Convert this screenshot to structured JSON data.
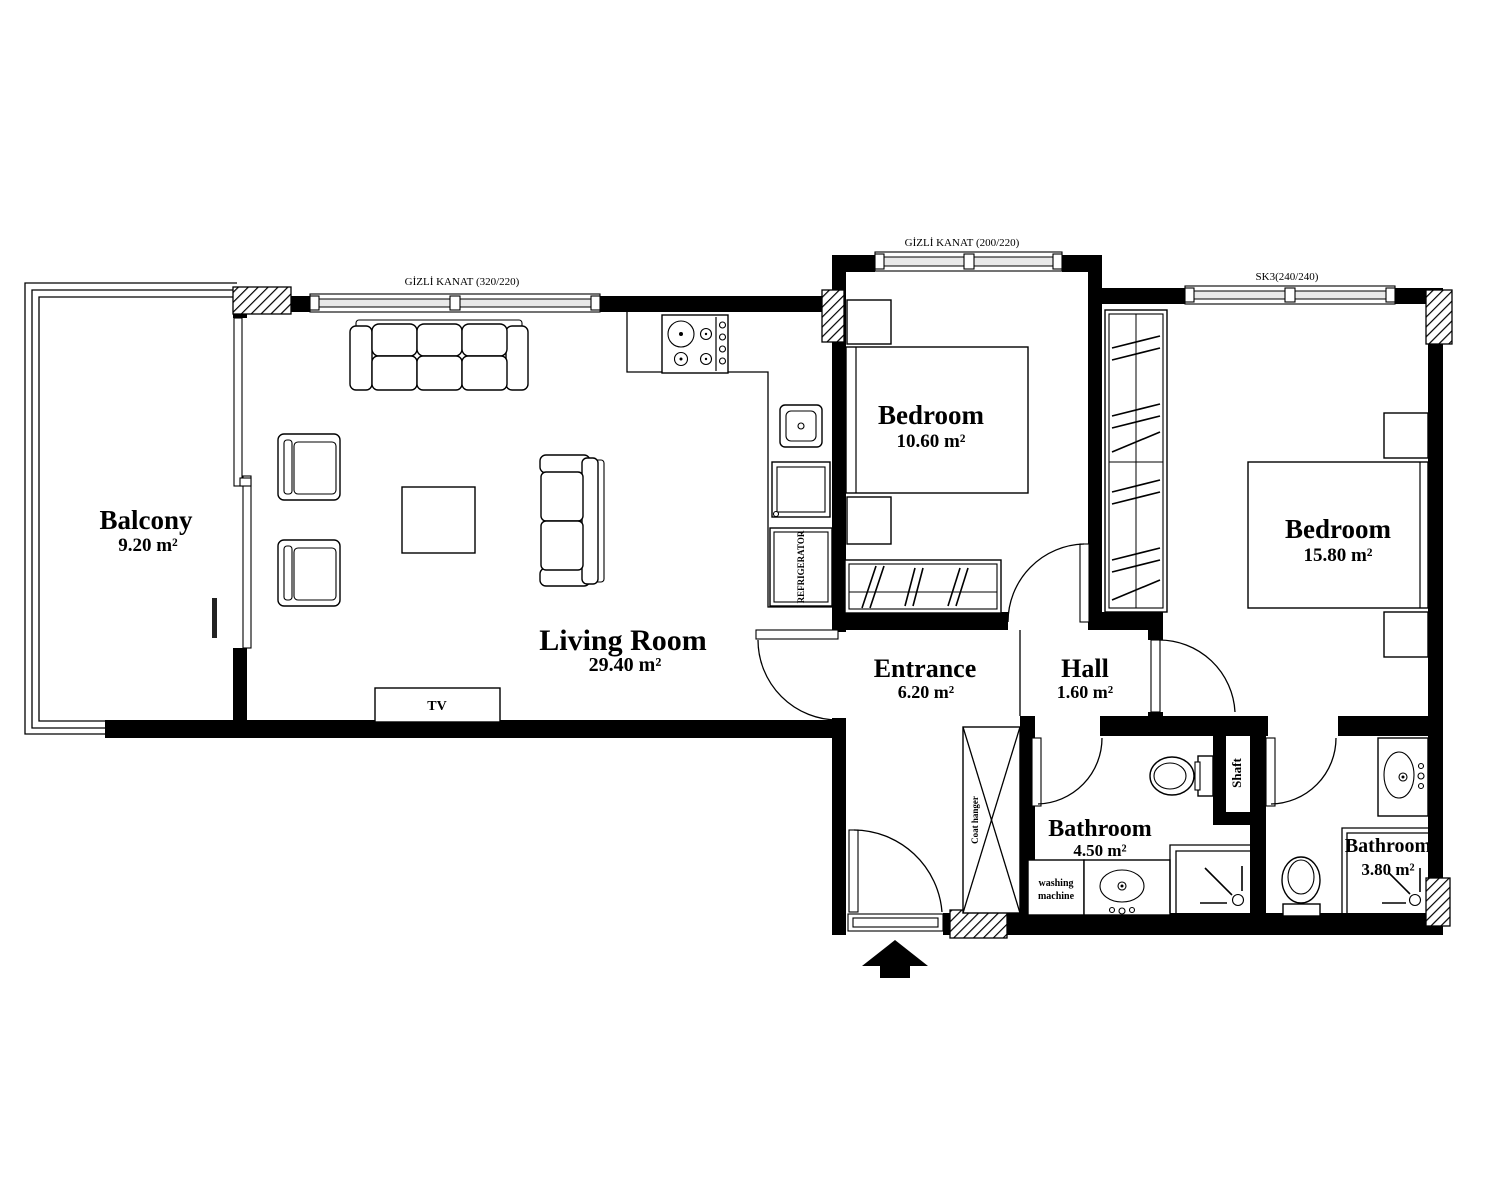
{
  "rooms": {
    "balcony": {
      "name": "Balcony",
      "area": "9.20 m²"
    },
    "living_room": {
      "name": "Living Room",
      "area": "29.40 m²"
    },
    "bedroom_small": {
      "name": "Bedroom",
      "area": "10.60 m²"
    },
    "bedroom_large": {
      "name": "Bedroom",
      "area": "15.80 m²"
    },
    "entrance": {
      "name": "Entrance",
      "area": "6.20 m²"
    },
    "hall": {
      "name": "Hall",
      "area": "1.60 m²"
    },
    "bathroom_main": {
      "name": "Bathroom",
      "area": "4.50 m²"
    },
    "bathroom_ensuite": {
      "name": "Bathroom",
      "area": "3.80 m²"
    },
    "shaft": {
      "name": "Shaft"
    }
  },
  "window_labels": {
    "living_room_window": "GİZLİ KANAT (320/220)",
    "bedroom_small_window": "GİZLİ KANAT (200/220)",
    "bedroom_large_window": "SK3(240/240)"
  },
  "fixtures": {
    "tv": "TV",
    "refrigerator": "REFRIGERATOR",
    "coat_hanger": "Coat hanger",
    "washing_machine_line1": "washing",
    "washing_machine_line2": "machine"
  },
  "colors": {
    "wall": "#000000",
    "background": "#ffffff",
    "line": "#000000"
  }
}
